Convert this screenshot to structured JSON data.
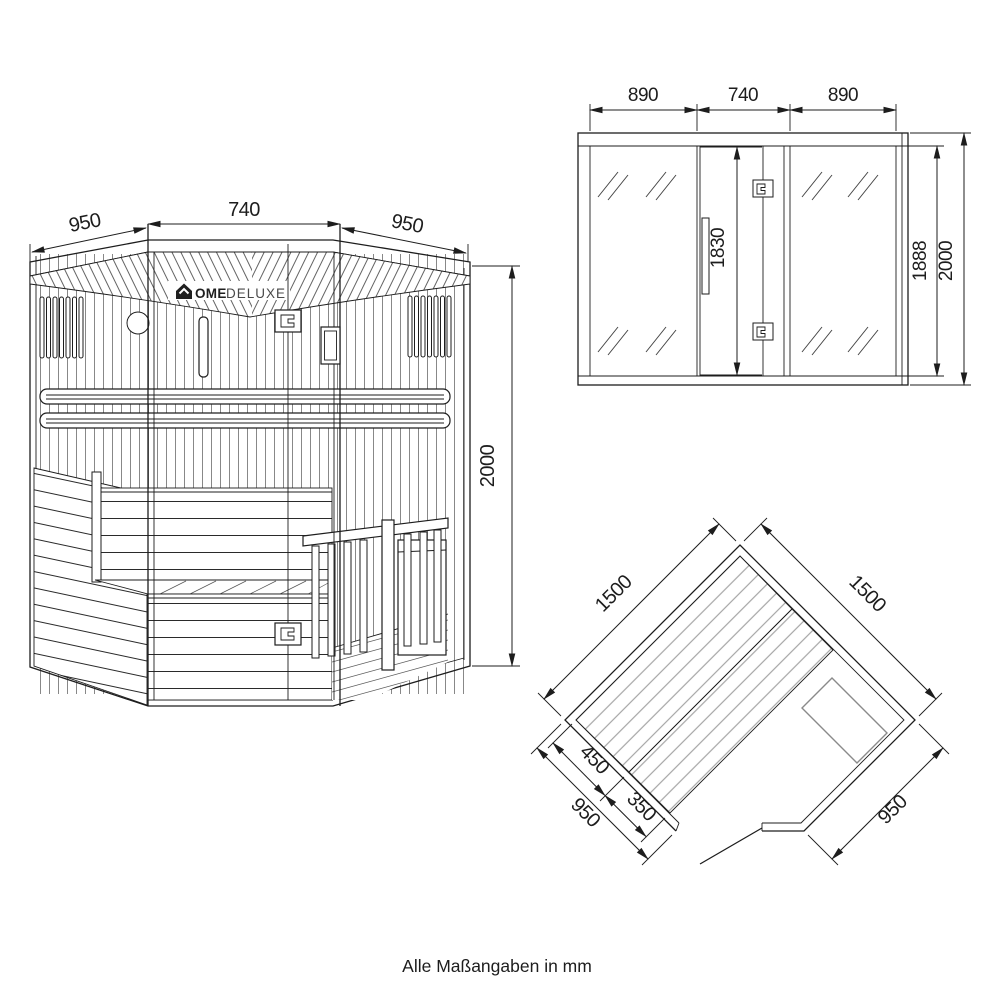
{
  "sheet": {
    "units_note": "Alle Maßangaben in mm",
    "background": "#ffffff",
    "line_color": "#1d1d1d",
    "slat_color": "#a5a5a5",
    "heater_color": "#8a8a8a"
  },
  "brand": {
    "full_name": "HOME DELUXE",
    "icon": "house-icon",
    "name_bold": "OME",
    "name_light": "DELUXE"
  },
  "views": {
    "perspective": {
      "dims": {
        "roof_left_depth": "950",
        "door_width": "740",
        "roof_right_depth": "950",
        "total_height": "2000"
      }
    },
    "elevation": {
      "dims": {
        "left_glass_width": "890",
        "door_width": "740",
        "right_glass_width": "890",
        "door_height": "1830",
        "glass_height": "1888",
        "total_height": "2000"
      }
    },
    "plan": {
      "dims": {
        "back_wall_left": "1500",
        "back_wall_right": "1500",
        "bench_depth_upper": "450",
        "bench_depth_lower": "350",
        "side_front_left": "950",
        "side_front_right": "950"
      }
    }
  }
}
